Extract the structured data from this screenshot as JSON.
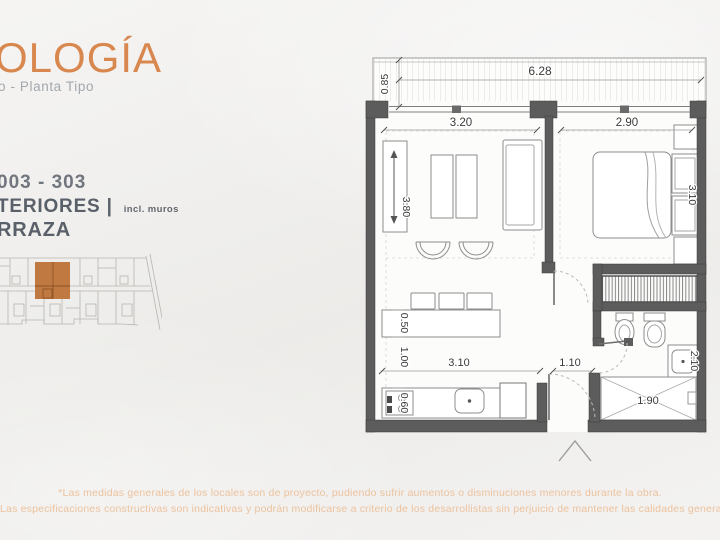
{
  "header": {
    "title": "OLOGÍA",
    "subtitle": "o - Planta Tipo"
  },
  "info": {
    "units": "003 - 303",
    "interiors_label": "TERIORES |",
    "interiors_note": "incl. muros",
    "terrace_label": "RRAZA"
  },
  "plan": {
    "dims": {
      "terrace_width": "6.28",
      "terrace_depth": "0.85",
      "living_width": "3.20",
      "bedroom_width": "2.90",
      "living_length": "3.80",
      "bedroom_length": "3.10",
      "island_depth": "0.50",
      "island_clearance": "1.00",
      "kitchen_width": "3.10",
      "counter_depth": "0.60",
      "hall_width": "1.10",
      "bath_length": "2.10",
      "shower_width": "1.90"
    }
  },
  "footer": {
    "line1": "*Las medidas generales de los locales son de proyecto, pudiendo sufrir aumentos o disminuciones menores durante la obra.",
    "line2": "Las especificaciones constructivas son indicativas y podrán modificarse a criterio de los desarrollistas sin perjuicio de mantener las calidades generales."
  },
  "colors": {
    "accent_orange": "#d8884f",
    "footer_orange": "#ecc29e",
    "highlight_unit": "#c07a41",
    "wall_gray": "#5c5c5c",
    "text_gray": "#5a6069"
  }
}
